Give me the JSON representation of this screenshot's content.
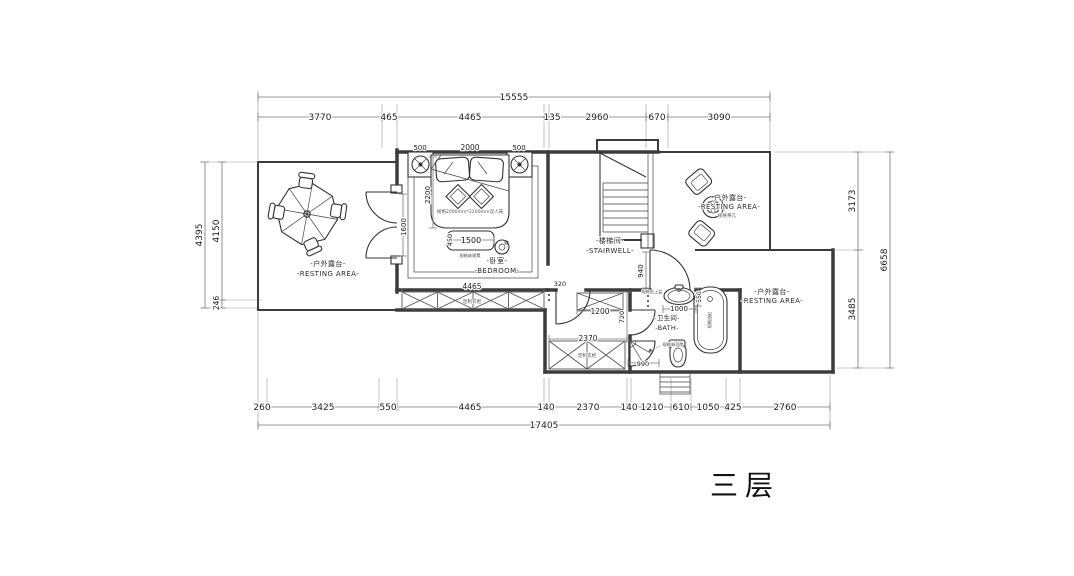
{
  "title": {
    "floor_label": "三层"
  },
  "rooms": {
    "terrace_left_zh": "-户外露台-",
    "terrace_left_en": "-RESTING AREA-",
    "bedroom_zh": "-卧室-",
    "bedroom_en": "-BEDROOM-",
    "stairwell_zh": "-楼梯间-",
    "stairwell_en": "-STAIRWELL-",
    "terrace_top_right_zh": "-户外露台-",
    "terrace_top_right_en": "-RESTING AREA-",
    "bath_zh": "-卫生间-",
    "bath_en": "-BATH-",
    "terrace_bottom_right_zh": "-户外露台-",
    "terrace_bottom_right_en": "-RESTING AREA-"
  },
  "annotations": {
    "bed_spec": "规格2000mm*2200mm双人床",
    "bench_spec": "规格床尾凳",
    "corridor_wardrobe": "定制衣柜",
    "lower_wardrobe": "定制衣柜",
    "tea_table": "规格茶几",
    "basin": "规格台上盆",
    "bathtub": "规格浴缸",
    "toilet": "马桶",
    "shower": "规格淋浴房"
  },
  "dims": {
    "top_total": "15555",
    "top_segs": [
      "3770",
      "465",
      "4465",
      "135",
      "2960",
      "670",
      "3090"
    ],
    "bottom_segs": [
      "260",
      "3425",
      "550",
      "4465",
      "140",
      "2370",
      "140",
      "1210",
      "610",
      "1050",
      "425",
      "2760"
    ],
    "bottom_total": "17405",
    "left": {
      "outer": "4395",
      "upper": "4150",
      "lower": "246"
    },
    "right": {
      "upper": "3173",
      "lower": "3485",
      "total": "6658"
    },
    "bed_side_left": "500",
    "bed_width": "2000",
    "bed_side_right": "500",
    "bed_length": "2200",
    "bench_length": "1500",
    "bench_depth": "450",
    "terrace_door": "1600",
    "hall_door": "940",
    "closet_door_stub": "320",
    "closet_top": "1200",
    "closet_depth": "720",
    "corridor_wardrobe": "4465",
    "lower_wardrobe": "2370",
    "shower_width": "990",
    "basin_width": "1000",
    "basin_depth": "550"
  }
}
